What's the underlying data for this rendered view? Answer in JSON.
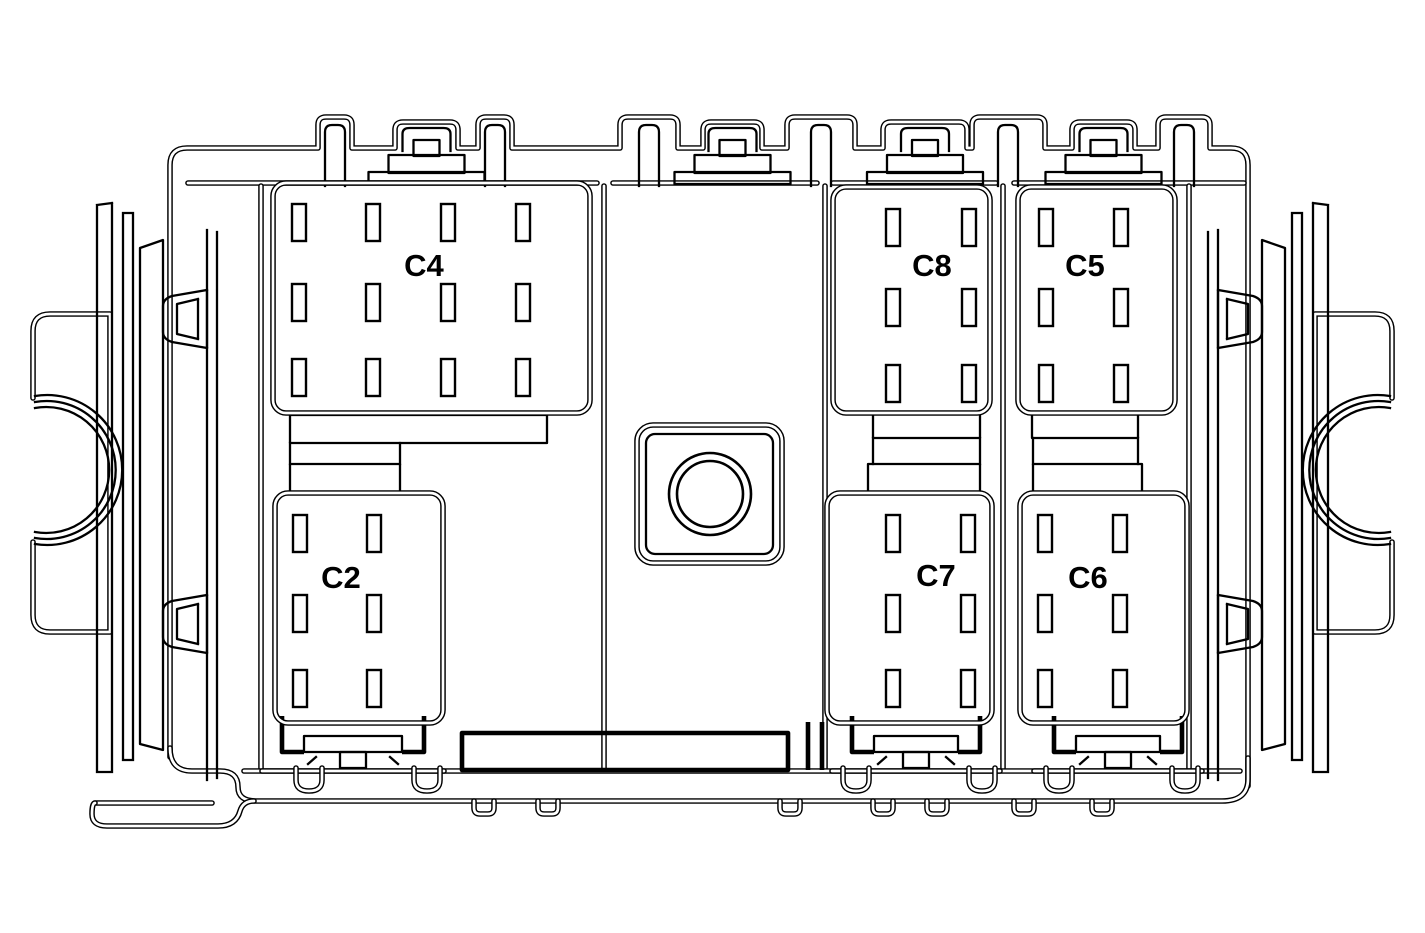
{
  "diagram": {
    "background_color": "#ffffff",
    "line_color": "#000000",
    "connectors": [
      {
        "id": "c4",
        "label": "C4",
        "pin_rows": 3,
        "pin_columns": 4,
        "pin_count": 12,
        "position": "top-left"
      },
      {
        "id": "c8",
        "label": "C8",
        "pin_rows": 3,
        "pin_columns": 2,
        "pin_count": 6,
        "position": "top-center-right"
      },
      {
        "id": "c5",
        "label": "C5",
        "pin_rows": 3,
        "pin_columns": 2,
        "pin_count": 6,
        "position": "top-right"
      },
      {
        "id": "c2",
        "label": "C2",
        "pin_rows": 3,
        "pin_columns": 2,
        "pin_count": 6,
        "position": "bottom-left"
      },
      {
        "id": "c7",
        "label": "C7",
        "pin_rows": 3,
        "pin_columns": 2,
        "pin_count": 6,
        "position": "bottom-center-right"
      },
      {
        "id": "c6",
        "label": "C6",
        "pin_rows": 3,
        "pin_columns": 2,
        "pin_count": 6,
        "position": "bottom-right"
      }
    ],
    "features": {
      "center_mounting_hole": "bolt-hole",
      "side_mounting_brackets": 2,
      "top_latch_tabs": 4,
      "bottom_latch_channels": 3
    }
  }
}
